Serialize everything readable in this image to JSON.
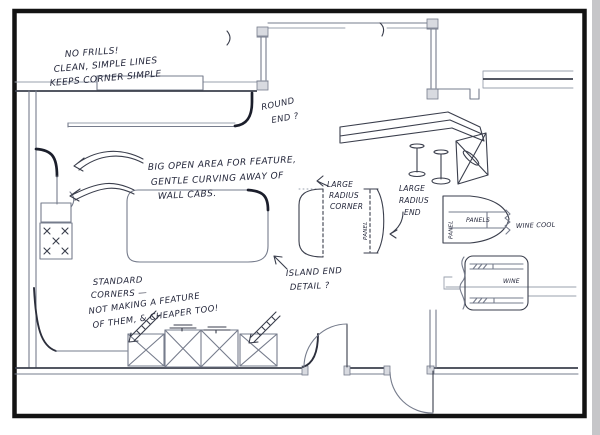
{
  "colors": {
    "paper": "#ffffff",
    "pencil": "#767c8c",
    "ink": "#23263a",
    "frame": "#131313"
  },
  "notes": {
    "no_frills": [
      "NO FRILLS!",
      "CLEAN, SIMPLE LINES",
      "KEEPS CORNER SIMPLE"
    ],
    "round_end": [
      "ROUND",
      "END ?"
    ],
    "big_open": [
      "BIG OPEN AREA FOR FEATURE,",
      "GENTLE CURVING AWAY OF",
      "WALL CABS."
    ],
    "large_radius_corner": [
      "LARGE",
      "RADIUS",
      "CORNER"
    ],
    "large_radius_end": [
      "LARGE",
      "RADIUS",
      "END"
    ],
    "island_end": [
      "ISLAND END",
      "DETAIL ?"
    ],
    "standard_corners": [
      "STANDARD",
      "CORNERS —",
      "NOT MAKING A FEATURE",
      "OF THEM, & CHEAPER TOO!"
    ]
  },
  "labels": {
    "panel": "PANEL",
    "panels": "PANELS",
    "wine_cool": "WINE COOL",
    "wine": "WINE"
  }
}
